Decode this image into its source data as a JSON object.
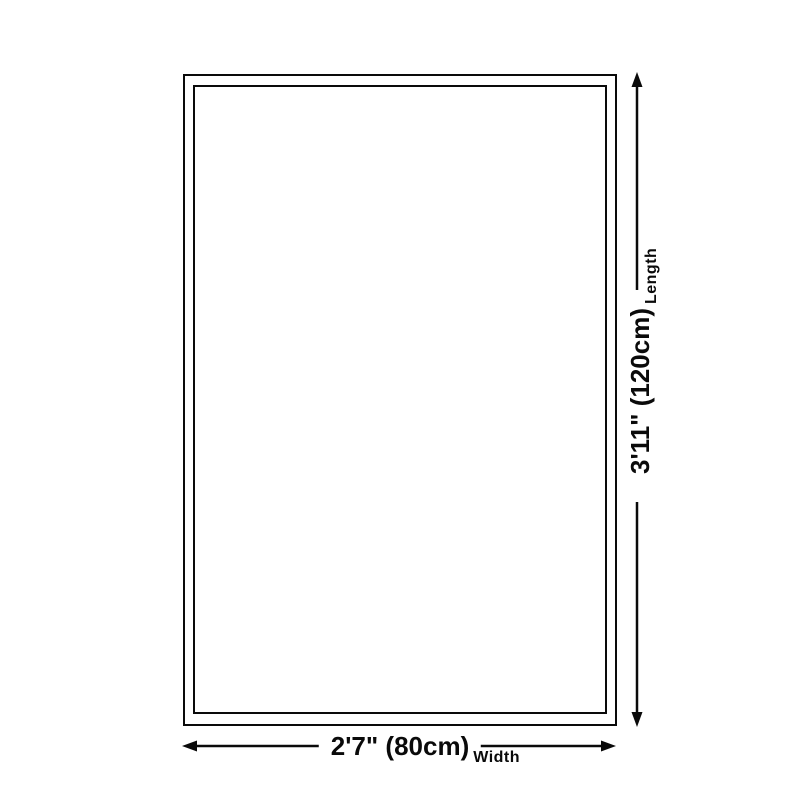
{
  "diagram": {
    "title": "product-size-diagram",
    "line_color": "#0a0a0a",
    "background_color": "#ffffff",
    "length": {
      "value": "3'11\" (120cm)",
      "axis_label": "Length"
    },
    "width": {
      "value": "2'7\" (80cm)",
      "axis_label": "Width"
    }
  }
}
